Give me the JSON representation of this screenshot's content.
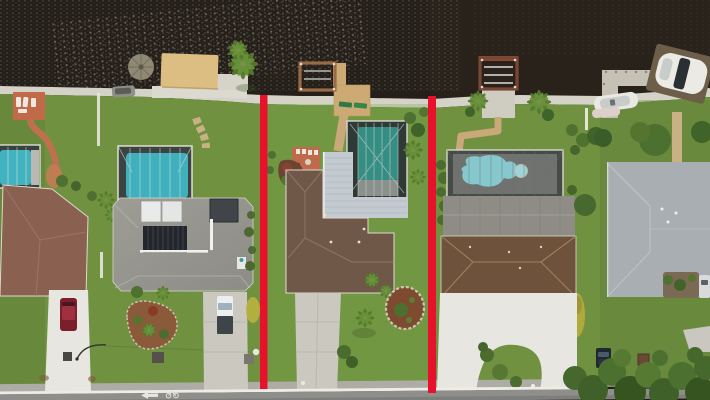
{
  "image": {
    "title": "Aerial top-down drone photo of waterfront homes; the center lot is outlined with two vertical red property-boundary lines",
    "width": 710,
    "height": 400
  },
  "annotation": {
    "type": "property-boundary-highlight",
    "color": "#e8112c",
    "lines": [
      {
        "side": "left",
        "x": 260,
        "y_top": 95,
        "y_bottom": 389
      },
      {
        "side": "right",
        "x": 428,
        "y_top": 96,
        "y_bottom": 393
      }
    ]
  },
  "scene": {
    "setting": "canal-front residential neighborhood, top-down view, water at top, street at bottom",
    "water": {
      "position": "top",
      "description": "dark canal water with sun glitter at upper left"
    },
    "properties": [
      {
        "id": "far-left",
        "features": [
          "terracotta patio with white loungers",
          "curved terracotta path",
          "screened aqua pool",
          "brown tile hip roof",
          "white driveway",
          "dark red car",
          "street lamp"
        ]
      },
      {
        "id": "left",
        "features": [
          "thatched tiki hut",
          "tan boat canopy",
          "gray moored boat",
          "tall palm",
          "screened aqua pool",
          "gray shingle roof with solar panels and white skylights",
          "concrete driveway",
          "white pickup with dark bed",
          "teardrop landscape island",
          "golden shrub"
        ]
      },
      {
        "id": "center-outlined",
        "features": [
          "wood dock with boat lift",
          "paver sun deck with two green loungers",
          "terracotta patio",
          "screened dark-teal pool",
          "white ribbed lanai roof",
          "brown shingle hip roof with roof vents",
          "concrete driveway",
          "oval mulch island with white stone border",
          "lawn palm"
        ]
      },
      {
        "id": "right",
        "features": [
          "rust boat-lift frame dock",
          "twin palms",
          "L-shaped paver path",
          "screened kidney pool with round spa",
          "two-tone gray and brown hip roof",
          "golden column shrub",
          "white circular driveway with grass island",
          "brown utility box"
        ]
      },
      {
        "id": "far-right",
        "features": [
          "L-shaped concrete dock",
          "white center-console boat",
          "large white boat on lift",
          "paver path",
          "pale blue-gray hip roof with vents",
          "garden courtyard",
          "silver car",
          "dark parked car",
          "dense trees overhanging the road"
        ]
      }
    ],
    "road": {
      "position": "bottom",
      "surface": "asphalt with concrete gutter",
      "edge_line": "white",
      "lane_markings": [
        "left-pointing arrow",
        "bicycle symbol"
      ]
    }
  },
  "colors": {
    "water": "#241f19",
    "water_right": "#2b241c",
    "seawall": "#d5d2c8",
    "grass": "#6f9140",
    "road_asphalt": "#8e8e8b",
    "road_gutter": "#aeaca6",
    "road_line": "#eeece5",
    "boundary_red": "#e8112c",
    "roof_far_left": "#8a6150",
    "roof_left": "#96968f",
    "roof_middle": "#6f5847",
    "roof_right_gray": "#8e8c85",
    "roof_right_brown": "#6e523c",
    "roof_far_right": "#a9aeb3",
    "roof_lanai_white": "#c3cad0",
    "pool_far_left": "#41b2c0",
    "pool_left": "#3fb0bd",
    "pool_middle": "#348e84",
    "pool_right": "#86c8cd",
    "driveway_white": "#e7e6e0",
    "driveway_concrete": "#cbc8c0",
    "canopy_tan": "#dcbd82",
    "deck_tan": "#cdaa74",
    "patio_terracotta": "#bf6b4b",
    "mulch": "#7e4a30",
    "paver_path": "#c9a87a"
  }
}
